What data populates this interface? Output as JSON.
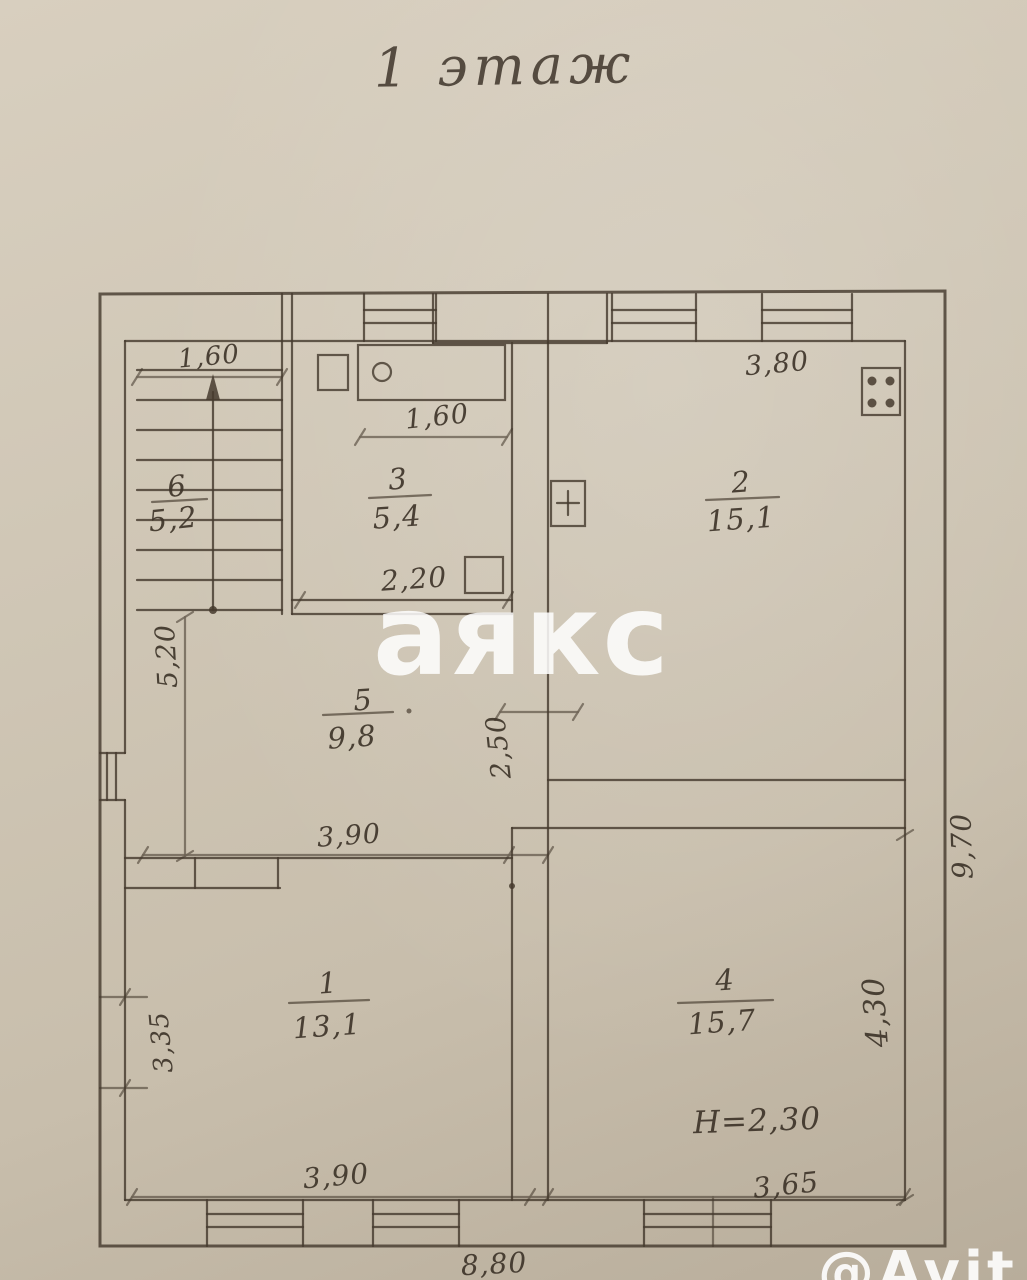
{
  "title": "1 этаж",
  "watermark": {
    "center": "аякс",
    "corner": "@Avit"
  },
  "rooms": [
    {
      "number": "6",
      "area": "5,2"
    },
    {
      "number": "3",
      "area": "5,4"
    },
    {
      "number": "2",
      "area": "15,1"
    },
    {
      "number": "5",
      "area": "9,8"
    },
    {
      "number": "1",
      "area": "13,1"
    },
    {
      "number": "4",
      "area": "15,7"
    }
  ],
  "dims": {
    "stairs_width": "1,60",
    "bath_width": "1,60",
    "room3_width": "2,20",
    "room2_width": "3,80",
    "left_span": "5,20",
    "hall_depth": "2,50",
    "hall_width": "3,90",
    "room1_depth": "3,35",
    "room1_width": "3,90",
    "room4_width": "3,65",
    "room4_depth": "4,30",
    "house_width": "8,80",
    "house_depth": "9,70",
    "ceiling_height": "Н=2,30"
  },
  "colors": {
    "paper": "#cfc6b5",
    "ink": "#463b2e",
    "watermark": "#ffffff"
  }
}
